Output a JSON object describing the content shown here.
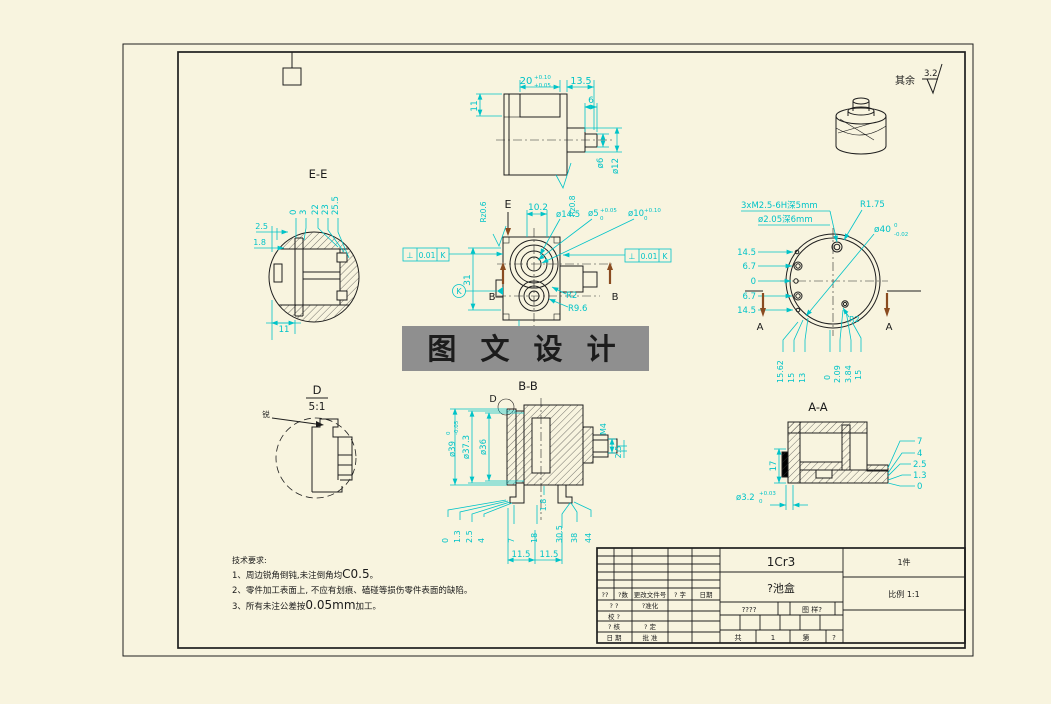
{
  "finish_note": {
    "label": "其余",
    "value": "3.2"
  },
  "top_view": {
    "dim_20": "20",
    "dim_20_up": "+0.10",
    "dim_20_lo": "+0.05",
    "dim_13_5": "13.5",
    "dim_11": "11",
    "dim_6": "6",
    "dia_6": "ø6",
    "dia_12": "ø12",
    "rz": "Rz0.8"
  },
  "ee_view": {
    "title": "E-E",
    "d0": "0",
    "d3": "3",
    "d22": "22",
    "d23": "23",
    "d25_5": "25.5",
    "d2_5": "2.5",
    "d1_8": "1.8",
    "d11": "11"
  },
  "front_view": {
    "e_label": "E",
    "b_left": "B",
    "b_right": "B",
    "tol_sym": "⊥",
    "tol_val": "0.01",
    "tol_datum": "K",
    "datum_k": "K",
    "dim_31": "31",
    "dim_10_2": "10.2",
    "dia_14_5": "ø14.5",
    "dia_5": "ø5",
    "dia_5_up": "+0.05",
    "dia_5_lo": "0",
    "dia_10": "ø10",
    "dia_10_up": "+0.10",
    "dia_10_lo": "0",
    "r2": "R2",
    "r9_6": "R9.6",
    "rz": "Rz0.6"
  },
  "rear_view": {
    "thread_note": "3xM2.5-6H深5mm",
    "hole_note": "ø2.05深6mm",
    "r1_75": "R1.75",
    "dia_40": "ø40",
    "dia_40_up": "0",
    "dia_40_lo": "-0.02",
    "left_d1": "14.5",
    "left_d2": "6.7",
    "left_d3": "0",
    "left_d4": "6.7",
    "left_d5": "14.5",
    "bot_d1": "15.62",
    "bot_d2": "15",
    "bot_d3": "13",
    "bot_d4": "0",
    "bot_d5": "2.09",
    "bot_d6": "3.84",
    "bot_d7": "15",
    "r2": "R2",
    "a_left": "A",
    "a_right": "A"
  },
  "d_view": {
    "title": "D",
    "scale": "5:1",
    "note": "锐"
  },
  "bb_view": {
    "title": "B-B",
    "d_label": "D",
    "dia_39": "ø39",
    "dia_39_up": "0",
    "dia_39_lo": "-0.05",
    "dia_37_3": "ø37.3",
    "dia_36": "ø36",
    "m4": "M4",
    "d2_5": "2.5",
    "d1_8": "1.8",
    "bot": [
      "0",
      "1.3",
      "2.5",
      "4",
      "7",
      "18",
      "30.5",
      "38",
      "44"
    ],
    "d11_5a": "11.5",
    "d11_5b": "11.5"
  },
  "aa_view": {
    "title": "A-A",
    "dim_17": "17",
    "dia_3_2": "ø3.2",
    "dia_3_2_up": "+0.03",
    "dia_3_2_lo": "0",
    "r1": "7",
    "r2": "4",
    "r3": "2.5",
    "r4": "1.3",
    "r5": "0"
  },
  "watermark": "图 文 设 计",
  "tech_req": {
    "title": "技术要求:",
    "l1a": "1、周边锐角倒钝,未注倒角均",
    "l1b": "C0.5",
    "l1c": "。",
    "l2": "2、零件加工表面上, 不应有划痕、磕碰等损伤零件表面的缺陷。",
    "l3a": "3、所有未注公差按",
    "l3b": "0.05mm",
    "l3c": "加工。"
  },
  "title_block": {
    "material": "1Cr3",
    "part_name": "?池盒",
    "quantity": "1件",
    "scale": "比例  1:1",
    "header": {
      "c1": "??",
      "c2": "?数",
      "c3": "更改文件号",
      "c4": "? 字",
      "c5": "日期"
    },
    "rows": {
      "r1l": "? ?",
      "r1m": "?准化",
      "r2l": "校 ?",
      "r3l": "? 核",
      "r3m": "? 定",
      "r4l": "日 期",
      "r4m": "批 准"
    },
    "mark_cell": "????",
    "weight_cell": "图 样?",
    "sheet": {
      "gong": "共",
      "total": "1",
      "di": "第",
      "num": "?"
    }
  }
}
